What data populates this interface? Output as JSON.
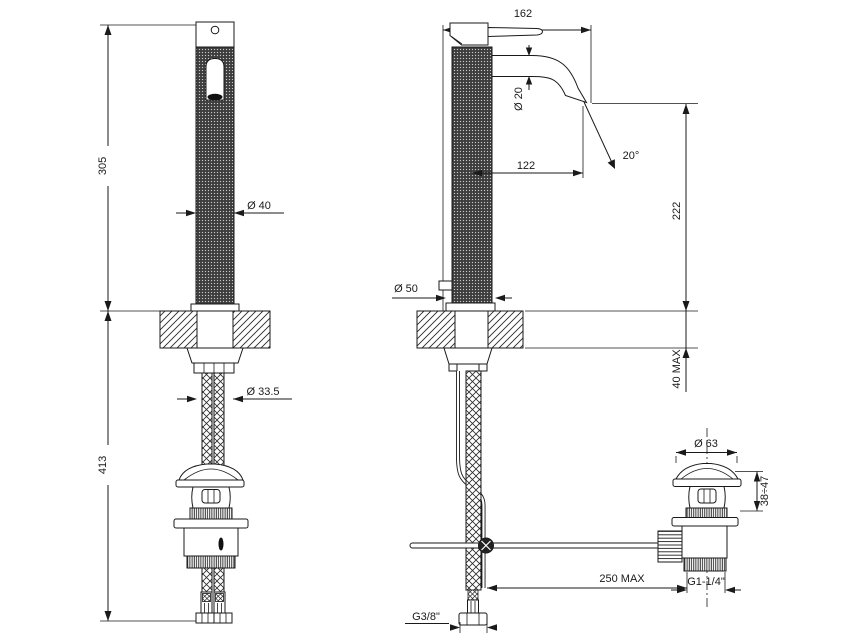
{
  "drawing_colors": {
    "line": "#1a1a1a",
    "background": "#ffffff"
  },
  "front_view": {
    "height_above_deck": "305",
    "height_below_deck": "413",
    "body_diameter": "Ø 40",
    "mounting_hole_diameter": "Ø 33.5"
  },
  "side_view": {
    "total_depth": "162",
    "spout_diameter": "Ø 20",
    "spout_reach": "122",
    "stream_angle": "20°",
    "spout_height_above_deck": "222",
    "deck_thickness": "40 MAX",
    "base_diameter": "Ø 50",
    "supply_hose_thread": "G3/8\"",
    "popup_rod_reach": "250 MAX"
  },
  "drain": {
    "cap_diameter": "Ø 63",
    "adjustment_range": "38÷47",
    "waste_thread": "G1-1/4\""
  }
}
